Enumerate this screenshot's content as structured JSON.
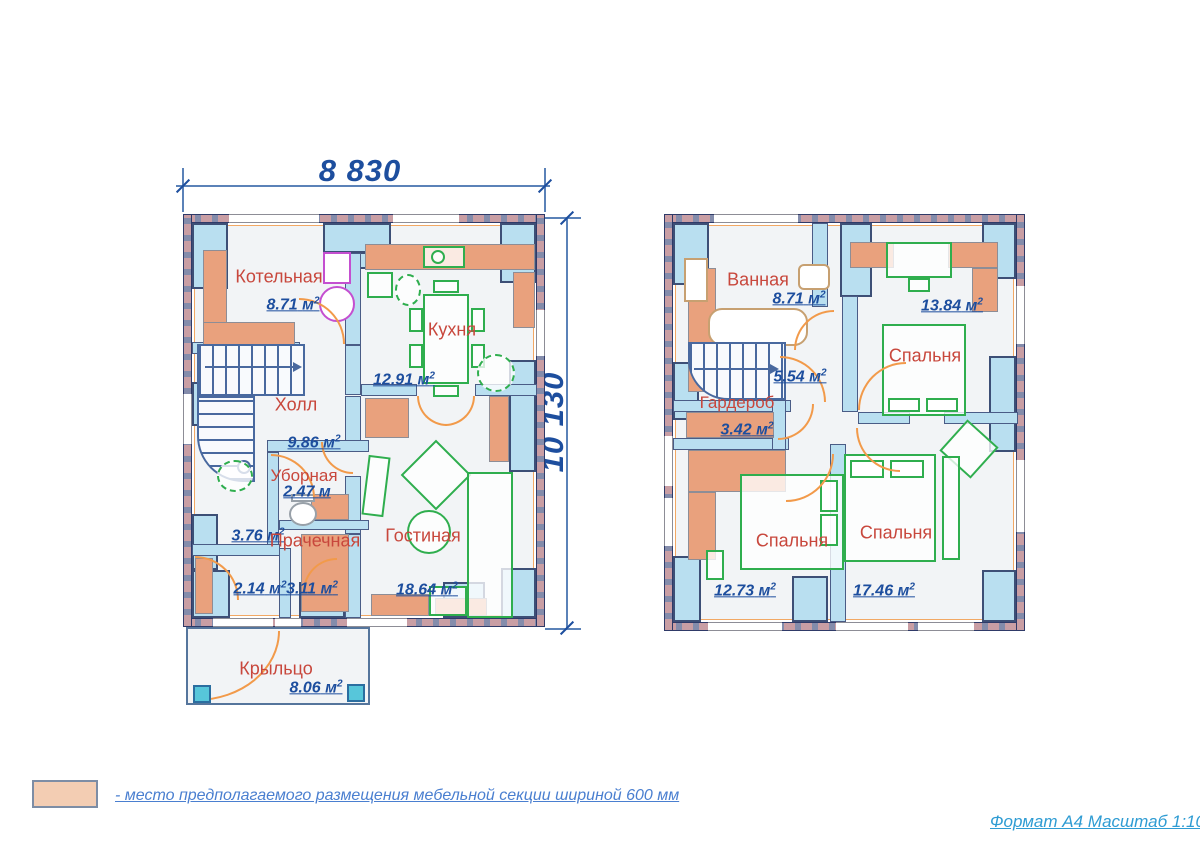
{
  "dimensions": {
    "width": "8 830",
    "height": "10 130"
  },
  "floor1": {
    "rooms": [
      {
        "name": "Котельная",
        "area": "8.71",
        "unit": "м",
        "sup": "2"
      },
      {
        "name": "Кухня",
        "area": "12.91",
        "unit": "м",
        "sup": "2"
      },
      {
        "name": "Холл",
        "area": "9.86",
        "unit": "м",
        "sup": "2"
      },
      {
        "name": "Уборная",
        "area": "2.47",
        "unit": "м",
        "sup": ""
      },
      {
        "name": "",
        "area": "3.76",
        "unit": "м",
        "sup": "2"
      },
      {
        "name": "Прачечная",
        "area": "3.11",
        "unit": "м",
        "sup": "2"
      },
      {
        "name": "",
        "area": "2.14",
        "unit": "м",
        "sup": "2"
      },
      {
        "name": "Гостиная",
        "area": "18.64",
        "unit": "м",
        "sup": "2"
      },
      {
        "name": "Крыльцо",
        "area": "8.06",
        "unit": "м",
        "sup": "2"
      }
    ]
  },
  "floor2": {
    "rooms": [
      {
        "name": "Ванная",
        "area": "8.71",
        "unit": "м",
        "sup": "2"
      },
      {
        "name": "Спальня",
        "area": "13.84",
        "unit": "м",
        "sup": "2"
      },
      {
        "name": "",
        "area": "5.54",
        "unit": "м",
        "sup": "2"
      },
      {
        "name": "Гардероб",
        "area": "3.42",
        "unit": "м",
        "sup": "2"
      },
      {
        "name": "Спальня",
        "area": "12.73",
        "unit": "м",
        "sup": "2"
      },
      {
        "name": "Спальня",
        "area": "17.46",
        "unit": "м",
        "sup": "2"
      }
    ]
  },
  "legend": {
    "text": "- место предполагаемого размещения мебельной секции шириной 600 мм",
    "swatch_color": "#f3cdb3"
  },
  "footer": {
    "text": "Формат А4 Масштаб 1:100"
  },
  "colors": {
    "dimension_text": "#1d4e9e",
    "room_name_text": "#c8473c",
    "area_text": "#1d4e9e",
    "legend_text": "#4a7fd0",
    "footer_text": "#2f9cd3",
    "wall_brick_pink": "#c99ea4",
    "wall_brick_slate": "#848cab",
    "pier_blue": "#b9dff0",
    "furniture_zone_peach": "#e9a17d",
    "furniture_outline_green": "#2fae4e",
    "door_arc_orange": "#f29a4a",
    "stairs_blue": "#49699f",
    "porch_column_cyan": "#57c6da"
  }
}
